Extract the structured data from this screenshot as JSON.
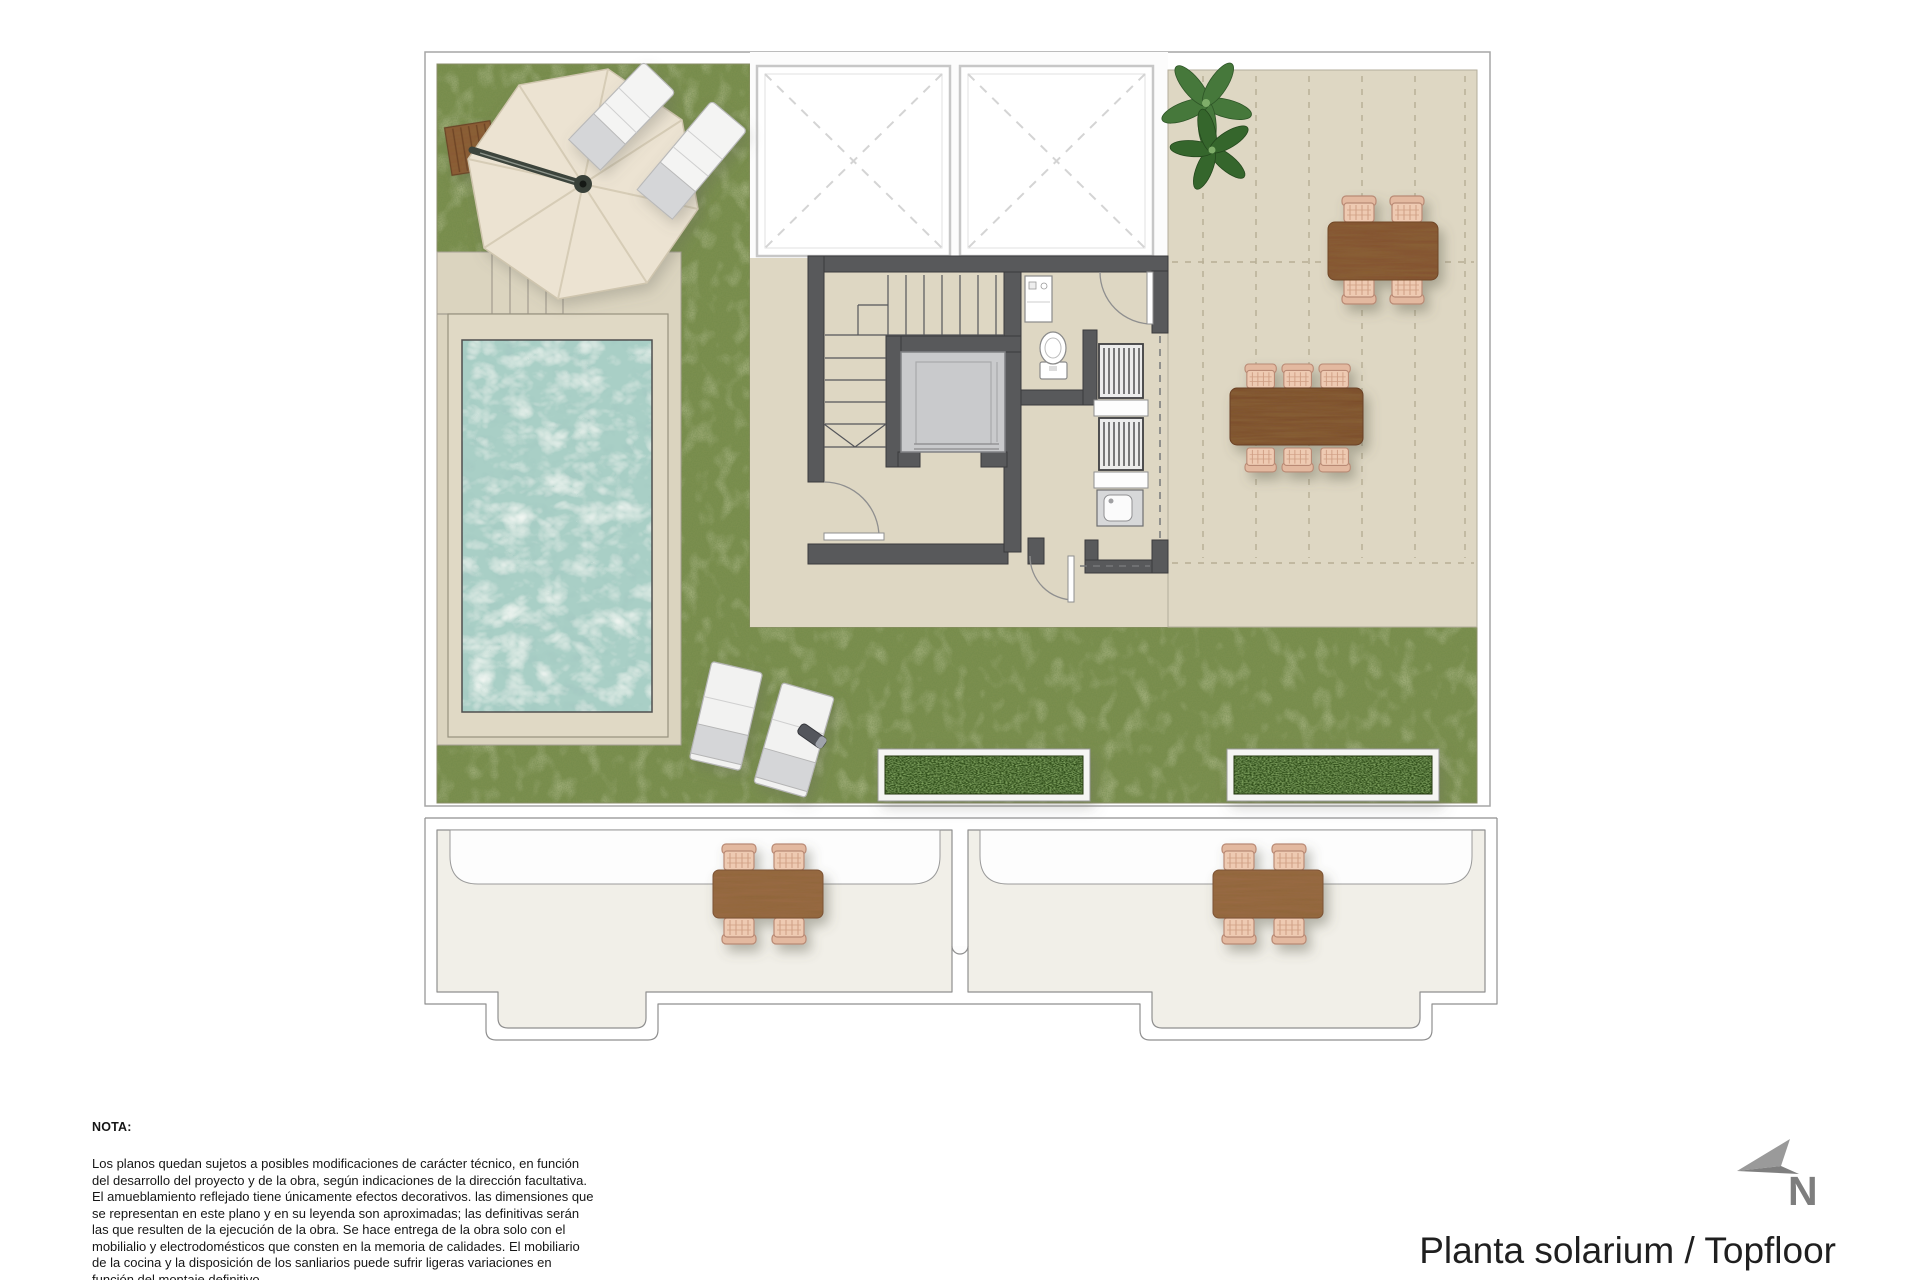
{
  "title": {
    "label": "Planta solarium / Topfloor"
  },
  "compass": {
    "label": "N",
    "icon": "north-arrow-icon"
  },
  "note": {
    "heading": "NOTA:",
    "body": "Los planos quedan sujetos a posibles modificaciones de carácter técnico, en función del desarrollo del proyecto y de la obra, según indicaciones de la dirección facultativa. El amueblamiento reflejado tiene únicamente efectos decorativos. las dimensiones que se representan en este plano y en su leyenda son aproximadas; las definitivas serán las que resulten de la ejecución de la obra. Se hace entrega de la obra solo con el mobilialio y electrodomésticos que consten en la memoria de calidades. El mobiliario de la cocina y la disposición de los sanliarios puede sufrir ligeras variaciones en función del montaje definitivo."
  },
  "plan": {
    "features": [
      "lawn",
      "swimming-pool",
      "pool-deck-steps",
      "cantilever-umbrella",
      "sun-loungers",
      "tiled-terrace",
      "pergola-grid",
      "outdoor-dining-tables",
      "wicker-chairs",
      "planters",
      "staircase",
      "elevator",
      "toilet",
      "utility-room",
      "skylights",
      "lower-floor-terraces",
      "plant"
    ]
  },
  "colors": {
    "grass": "#7b8f4f",
    "planter_green": "#31511f",
    "water": "#a9cfc6",
    "terrace_beige": "#ded7c3",
    "deck_beige": "#dbd4bf",
    "wall_gray": "#58595b",
    "elevator_gray": "#c9cacc",
    "wood_brown": "#845330",
    "wicker_tan": "#eecab2",
    "umbrella_cream": "#ece3d2",
    "lower_room": "#f1efe8",
    "outline_gray": "#8f8f8f",
    "text": "#161616",
    "title": "#1f1f1f",
    "compass": "#7e7e7e",
    "page": "#ffffff"
  }
}
